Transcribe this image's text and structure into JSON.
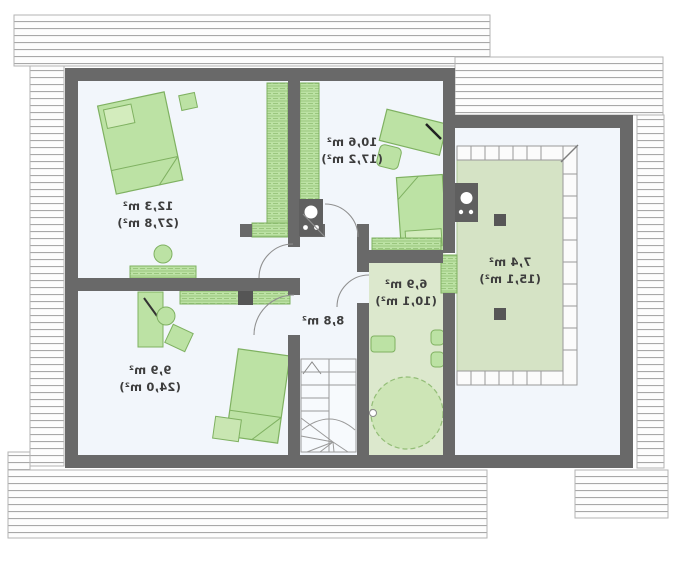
{
  "plan": {
    "type": "floor-plan-upper-storey",
    "mirrored_text": true,
    "rooms": [
      {
        "id": "bedroom",
        "area": "12,3 m²",
        "area_total": "(27,8 m²)"
      },
      {
        "id": "study",
        "area": "9,9 m²",
        "area_total": "(24,0 m²)"
      },
      {
        "id": "room-2",
        "area": "10,6 m²",
        "area_total": "(17,2 m²)"
      },
      {
        "id": "hall",
        "area": "8,8 m²",
        "area_total": ""
      },
      {
        "id": "bathroom",
        "area": "6,9 m²",
        "area_total": "(10,1 m²)"
      },
      {
        "id": "gallery",
        "area": "7,4 m²",
        "area_total": "(15,1 m²)"
      }
    ],
    "colors": {
      "wall": "#696969",
      "room_floor": "#f2f6fb",
      "bathroom_floor": "#dce8cd",
      "terrace_floor": "#d5e3c5",
      "furniture": "#bce2a4",
      "furniture_outline": "#7fb161",
      "roof_hatch_line": "#a8a8a8",
      "label_text": "#3d3d3d"
    }
  }
}
